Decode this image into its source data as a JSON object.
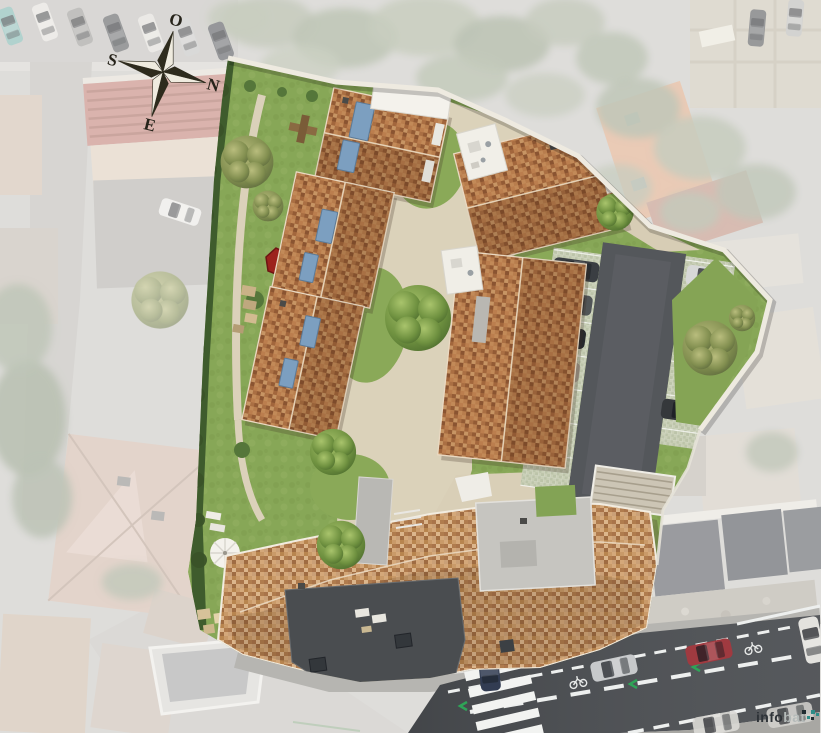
{
  "compass": {
    "top": "O",
    "right": "N",
    "bottom": "E",
    "left": "S"
  },
  "watermark": {
    "prefix": "info",
    "suffix": "bat"
  },
  "palette": {
    "lawn": "#87a757",
    "gravel": "#dbd2ba",
    "roof_terracotta": "#b0734a",
    "roof_terracotta_light": "#c79a6e",
    "parking_asphalt": "#54575b",
    "road": "#4b4e52",
    "sidewalk": "#b6b5b1",
    "boundary_wall": "#eeeae0",
    "hedge": "#3f5c2d",
    "solar_panel": "#7c9fc0",
    "accent_red": "#9c221d",
    "tree_green": "#6f9140",
    "tree_olive": "#828f50",
    "road_marking": "#edefee",
    "bike_lane_green": "#2fa457",
    "crosswalk": "#f2f3f1",
    "flat_roof_dark": "#4a4d50",
    "paver_stall": "#c9cfb6"
  }
}
